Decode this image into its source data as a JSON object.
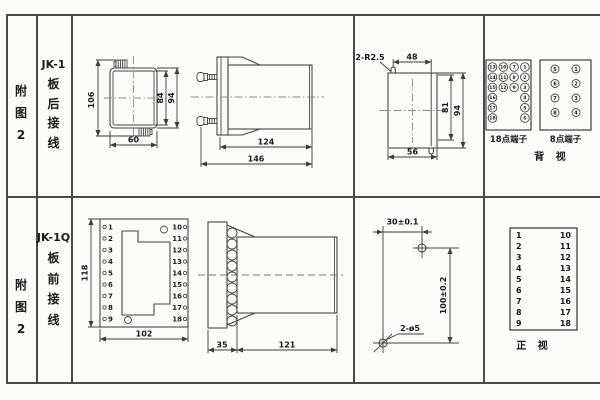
{
  "table": {
    "row1": {
      "fig_label": [
        "附",
        "图",
        "2"
      ],
      "model": "JK-1",
      "wiring": [
        "板",
        "后",
        "接",
        "线"
      ],
      "front_view": {
        "d_106": "106",
        "d_84": "84",
        "d_94": "94",
        "d_60": "60"
      },
      "side_view": {
        "d_124": "124",
        "d_146": "146"
      },
      "cutout": {
        "note": "2-R2.5",
        "d_48": "48",
        "d_81": "81",
        "d_94": "94",
        "d_56": "56"
      },
      "terminals": {
        "p18_label": "18点端子",
        "p18": [
          "13",
          "10",
          "7",
          "1",
          "14",
          "11",
          "8",
          "2",
          "15",
          "12",
          "9",
          "3",
          "16",
          "4",
          "17",
          "5",
          "18",
          "6"
        ],
        "p8_label": "8点端子",
        "p8": [
          "5",
          "1",
          "6",
          "2",
          "7",
          "3",
          "8",
          "4"
        ],
        "view_label": "背 视"
      }
    },
    "row2": {
      "fig_label": [
        "附",
        "图",
        "2"
      ],
      "model": "JK-1Q",
      "wiring": [
        "板",
        "前",
        "接",
        "线"
      ],
      "front_view": {
        "d_118": "118",
        "d_102": "102",
        "left_terms": [
          "1",
          "2",
          "3",
          "4",
          "5",
          "6",
          "7",
          "8",
          "9"
        ],
        "right_terms": [
          "10",
          "11",
          "12",
          "13",
          "14",
          "15",
          "16",
          "17",
          "18"
        ]
      },
      "side_view": {
        "d_35": "35",
        "d_121": "121"
      },
      "drill": {
        "d_30": "30±0.1",
        "d_100": "100±0.2",
        "note": "2-ø5"
      },
      "pin_table": {
        "left": [
          "1",
          "2",
          "3",
          "4",
          "5",
          "6",
          "7",
          "8",
          "9"
        ],
        "right": [
          "10",
          "11",
          "12",
          "13",
          "14",
          "15",
          "16",
          "17",
          "18"
        ],
        "view_label": "正 视"
      }
    }
  }
}
